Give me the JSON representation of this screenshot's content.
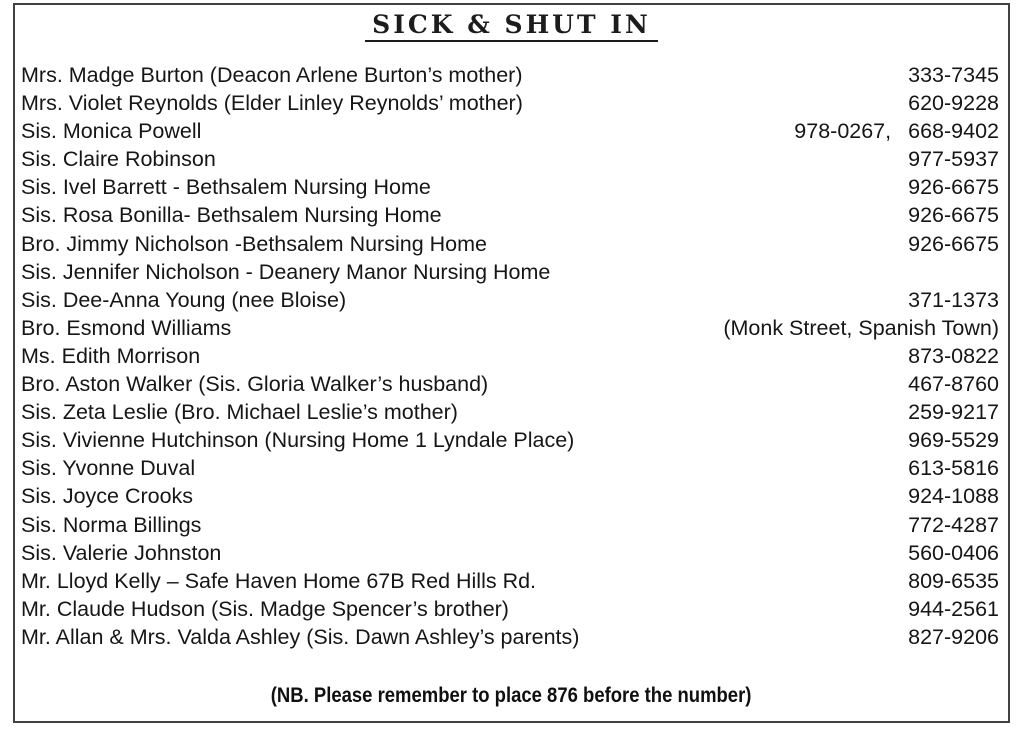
{
  "title": "SICK & SHUT IN",
  "entries": [
    {
      "name": "Mrs. Madge Burton (Deacon Arlene Burton’s mother)",
      "phone": "333-7345"
    },
    {
      "name": "Mrs. Violet Reynolds (Elder Linley Reynolds’ mother)",
      "phone": "620-9228"
    },
    {
      "name": "Sis. Monica Powell",
      "phone_prefix": "978-0267,",
      "phone": "668-9402"
    },
    {
      "name": "Sis. Claire Robinson",
      "phone": "977-5937"
    },
    {
      "name": "Sis. Ivel Barrett - Bethsalem Nursing Home",
      "phone": "926-6675"
    },
    {
      "name": "Sis. Rosa Bonilla- Bethsalem Nursing Home",
      "phone": "926-6675"
    },
    {
      "name": "Bro. Jimmy Nicholson -Bethsalem Nursing Home",
      "phone": "926-6675"
    },
    {
      "name": "Sis. Jennifer Nicholson - Deanery Manor Nursing Home",
      "phone": ""
    },
    {
      "name": "Sis. Dee-Anna Young (nee Bloise)",
      "phone": "371-1373"
    },
    {
      "name": "Bro. Esmond Williams",
      "phone": "(Monk Street, Spanish Town)"
    },
    {
      "name": "Ms. Edith Morrison",
      "phone": "873-0822"
    },
    {
      "name": "Bro. Aston Walker (Sis. Gloria Walker’s husband)",
      "phone": "467-8760"
    },
    {
      "name": "Sis. Zeta Leslie (Bro. Michael Leslie’s mother)",
      "phone": "259-9217"
    },
    {
      "name": "Sis. Vivienne Hutchinson (Nursing Home 1 Lyndale Place)",
      "phone": "969-5529"
    },
    {
      "name": "Sis. Yvonne Duval",
      "phone": "613-5816"
    },
    {
      "name": "Sis. Joyce Crooks",
      "phone": "924-1088"
    },
    {
      "name": "Sis. Norma Billings",
      "phone": "772-4287"
    },
    {
      "name": "Sis. Valerie Johnston",
      "phone": "560-0406"
    },
    {
      "name": "Mr. Lloyd Kelly – Safe Haven Home 67B Red Hills Rd.",
      "phone": "809-6535"
    },
    {
      "name": "Mr. Claude Hudson (Sis. Madge Spencer’s brother)",
      "phone": "944-2561"
    },
    {
      "name": "Mr. Allan & Mrs. Valda Ashley (Sis. Dawn Ashley’s parents)",
      "phone": "827-9206"
    }
  ],
  "footer_note": "(NB. Please remember to place 876 before the number)",
  "colors": {
    "ink": "#161616",
    "page": "#ffffff",
    "border": "#414141"
  }
}
